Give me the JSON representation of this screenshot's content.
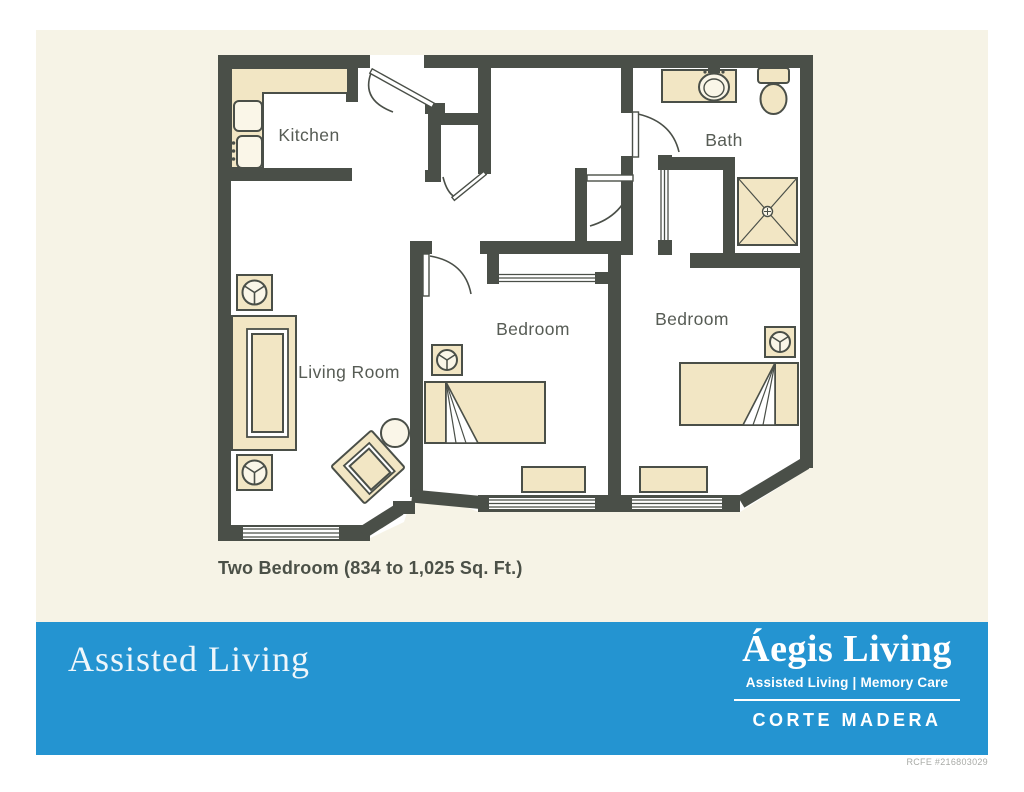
{
  "rooms": {
    "kitchen": "Kitchen",
    "bath": "Bath",
    "living_room": "Living Room",
    "bedroom_1": "Bedroom",
    "bedroom_2": "Bedroom"
  },
  "caption": "Two Bedroom (834 to 1,025 Sq. Ft.)",
  "footer": {
    "left_title": "Assisted Living",
    "brand": "Áegis Living",
    "brand_tagline": "Assisted Living | Memory Care",
    "location": "CORTE MADERA"
  },
  "license": "RCFE #216803029",
  "fixtures": [
    "kitchen-counter",
    "refrigerator",
    "kitchen-sink",
    "sofa",
    "side-table",
    "armchair",
    "round-table",
    "bed",
    "nightstand",
    "dresser",
    "window",
    "closet-sliding-doors",
    "bath-vanity",
    "bath-sink",
    "toilet",
    "shower"
  ],
  "colors": {
    "background_panel": "#f6f3e6",
    "walls": "#4a4f48",
    "furniture": "#f2e6c4",
    "room_fill": "#ffffff",
    "footer_band": "#2494d1",
    "label_text": "#575c55",
    "caption_text": "#4b5047",
    "license_text": "#a9aba7"
  }
}
